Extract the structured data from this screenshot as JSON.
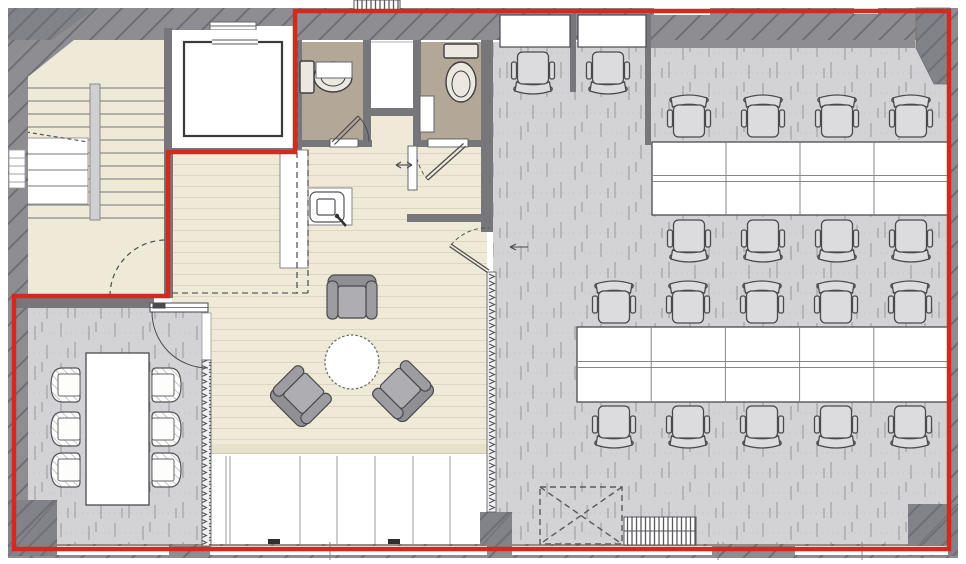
{
  "plan": {
    "type": "architectural-floor-plan",
    "colors": {
      "wall": "#8e8e92",
      "wallDark": "#828289",
      "wallHatch": "#6e6e75",
      "partition": "#76767b",
      "boundaryRed": "#d32a20",
      "wood": "#efead8",
      "woodLine": "#ddd6bf",
      "woodBand": "#e7e0ca",
      "carpet": "#d3d3d6",
      "carpetStreak": "#9fa0a6",
      "carpetDot": "#c3c3c8",
      "wcFloor": "#b3a798",
      "fixture": "#ece8e0",
      "armchair": "#9d9da1",
      "armchairBack": "#8f8f94",
      "armchairSeat": "#aeaeb2",
      "officeChair": "#dcdcdf",
      "outline": "#4a4a4e",
      "white": "#ffffff"
    },
    "summary": {
      "open_office_workstations": 20,
      "meeting_room_seats": 6,
      "lounge_seats": 3,
      "wc_rooms": 2,
      "elevators": 1,
      "stairs": 1
    },
    "furniture": {
      "desk_banks": [
        {
          "x": 652,
          "y": 142,
          "w": 296,
          "h": 73,
          "cols": 4
        },
        {
          "x": 577,
          "y": 327,
          "w": 371,
          "h": 75,
          "cols": 5
        }
      ],
      "wall_desks": [
        {
          "x": 500,
          "y": 15,
          "w": 70,
          "h": 32
        },
        {
          "x": 578,
          "y": 15,
          "w": 68,
          "h": 32
        }
      ],
      "office_chairs": [
        {
          "x": 533,
          "y": 70,
          "r": 180
        },
        {
          "x": 608,
          "y": 70,
          "r": 180
        },
        {
          "x": 689,
          "y": 119,
          "r": 0
        },
        {
          "x": 763,
          "y": 119,
          "r": 0
        },
        {
          "x": 837,
          "y": 119,
          "r": 0
        },
        {
          "x": 911,
          "y": 119,
          "r": 0
        },
        {
          "x": 689,
          "y": 238,
          "r": 180
        },
        {
          "x": 763,
          "y": 238,
          "r": 180
        },
        {
          "x": 837,
          "y": 238,
          "r": 180
        },
        {
          "x": 911,
          "y": 238,
          "r": 180
        },
        {
          "x": 614,
          "y": 305,
          "r": 0
        },
        {
          "x": 688,
          "y": 305,
          "r": 0
        },
        {
          "x": 762,
          "y": 305,
          "r": 0
        },
        {
          "x": 836,
          "y": 305,
          "r": 0
        },
        {
          "x": 910,
          "y": 305,
          "r": 0
        },
        {
          "x": 614,
          "y": 424,
          "r": 180
        },
        {
          "x": 688,
          "y": 424,
          "r": 180
        },
        {
          "x": 762,
          "y": 424,
          "r": 180
        },
        {
          "x": 836,
          "y": 424,
          "r": 180
        },
        {
          "x": 910,
          "y": 424,
          "r": 180
        }
      ],
      "meeting_table": {
        "x": 86,
        "y": 353,
        "w": 63,
        "h": 152
      },
      "meeting_chairs": [
        {
          "x": 69,
          "y": 385,
          "r": -90
        },
        {
          "x": 69,
          "y": 429,
          "r": -90
        },
        {
          "x": 69,
          "y": 470,
          "r": -90
        },
        {
          "x": 163,
          "y": 385,
          "r": 90
        },
        {
          "x": 163,
          "y": 429,
          "r": 90
        },
        {
          "x": 163,
          "y": 470,
          "r": 90
        }
      ],
      "round_table": {
        "cx": 352,
        "cy": 362,
        "r": 27
      },
      "lounge_armchairs": [
        {
          "x": 352,
          "y": 301,
          "r": 0
        },
        {
          "x": 303,
          "y": 394,
          "r": 225
        },
        {
          "x": 401,
          "y": 389,
          "r": 135
        }
      ]
    }
  }
}
